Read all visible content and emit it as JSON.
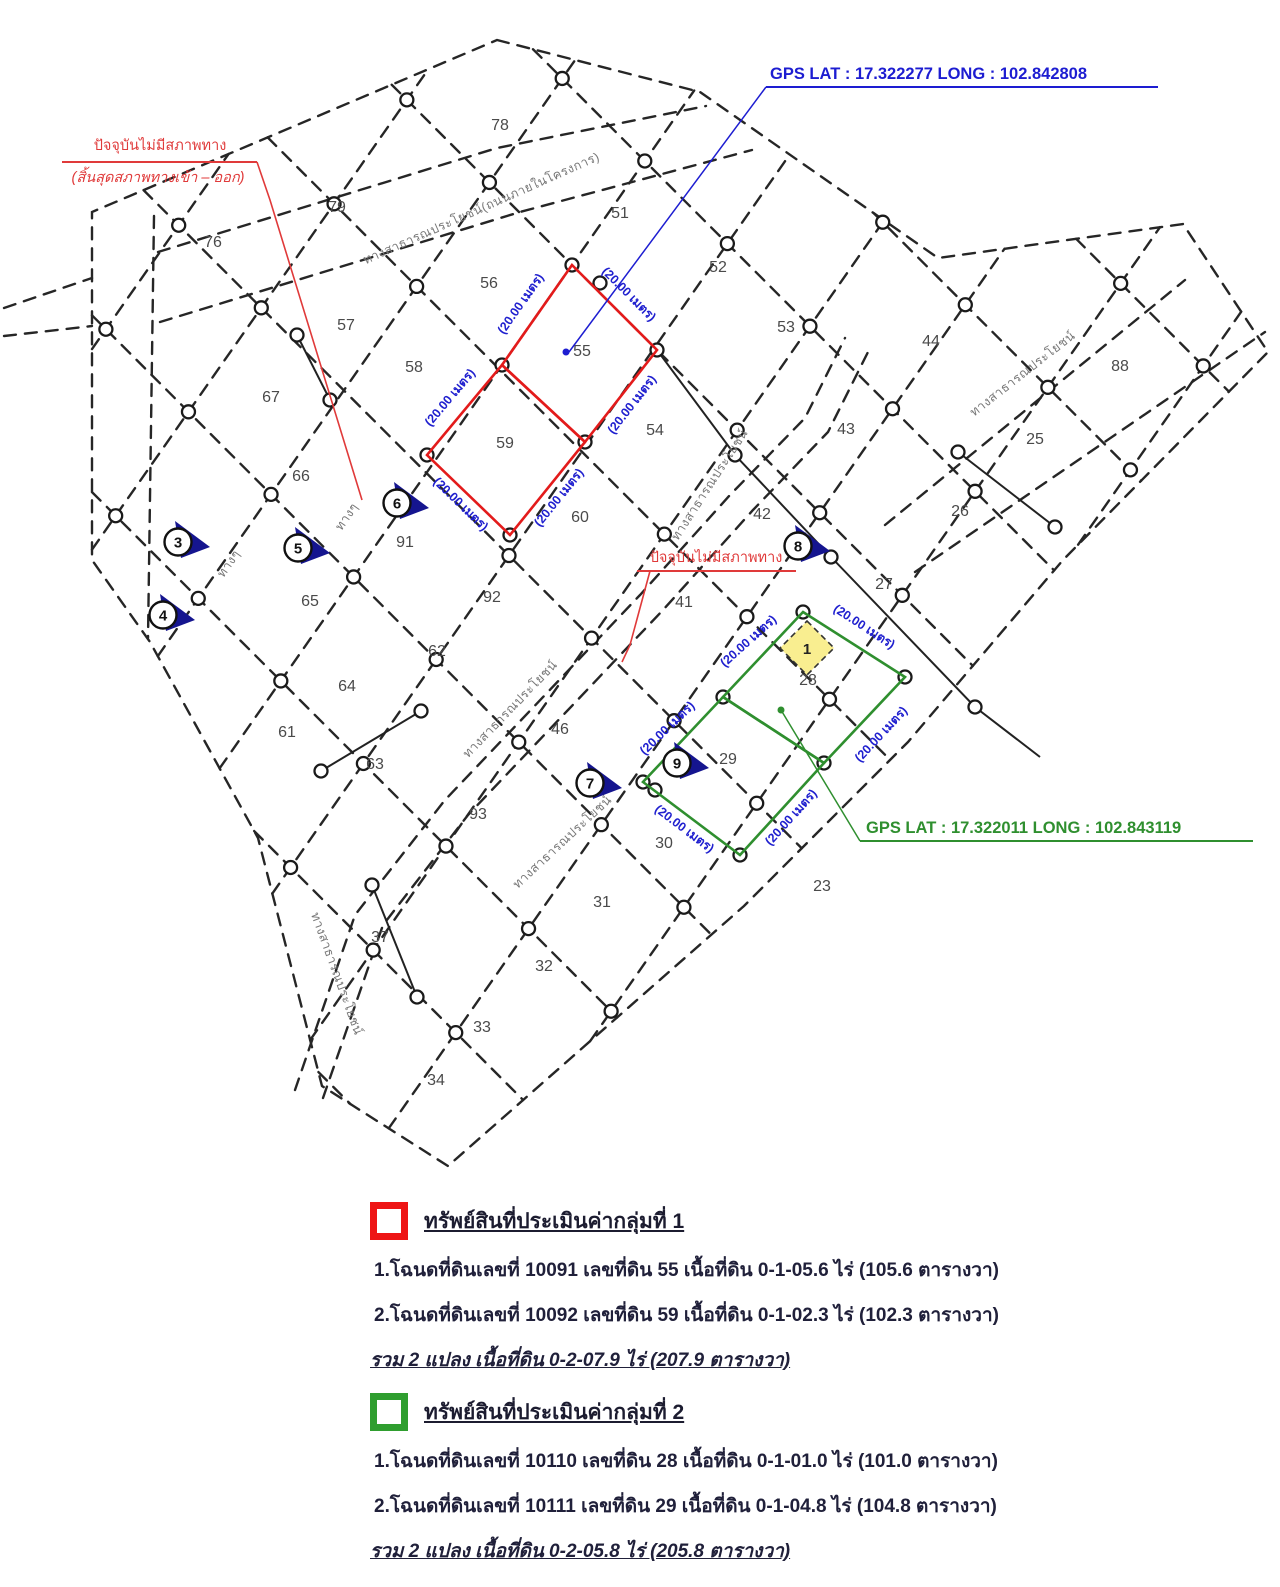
{
  "map": {
    "line_color": "#262626",
    "dim_text": "(20.00 เมตร)",
    "dim_color": "#2020cf",
    "gps1": {
      "text": "GPS  LAT :  17.322277  LONG :  102.842808",
      "x": 770,
      "y": 79,
      "ul": [
        766,
        87,
        1158
      ],
      "leader": [
        [
          766,
          87
        ],
        [
          569,
          352
        ]
      ],
      "dot": [
        566,
        352
      ],
      "color": "#1d1dd1"
    },
    "gps2": {
      "text": "GPS  LAT :  17.322011  LONG :  102.843119",
      "x": 866,
      "y": 833,
      "ul": [
        860,
        841,
        1253
      ],
      "leader": [
        [
          860,
          841
        ],
        [
          781,
          710
        ]
      ],
      "dot": [
        781,
        710
      ],
      "color": "#2f8f2f"
    },
    "red_note_top": {
      "line1": "ปัจจุบันไม่มีสภาพทาง",
      "line2": "(สิ้นสุดสภาพทางเข้า – ออก)",
      "x": 160,
      "y": 150,
      "ul": [
        62,
        162,
        257
      ],
      "leader": [
        [
          257,
          162
        ],
        [
          270,
          200
        ],
        [
          362,
          500
        ]
      ],
      "color": "#e03a3a"
    },
    "red_note_mid": {
      "text": "ปัจจุบันไม่มีสภาพทาง",
      "x": 716,
      "y": 562,
      "ul": [
        637,
        571,
        796
      ],
      "leader": [
        [
          650,
          571
        ],
        [
          630,
          645
        ],
        [
          622,
          662
        ]
      ],
      "color": "#e03a3a"
    },
    "group1": {
      "color": "#e31b1b",
      "quads": [
        [
          [
            572,
            265
          ],
          [
            657,
            350
          ],
          [
            585,
            442
          ],
          [
            502,
            365
          ]
        ],
        [
          [
            502,
            365
          ],
          [
            585,
            442
          ],
          [
            510,
            535
          ],
          [
            427,
            455
          ]
        ]
      ],
      "dims": [
        [
          524,
          306,
          -55
        ],
        [
          626,
          297,
          45
        ],
        [
          635,
          407,
          -52
        ],
        [
          453,
          400,
          -50
        ],
        [
          458,
          507,
          44
        ],
        [
          562,
          500,
          -51
        ]
      ]
    },
    "group2": {
      "color": "#2f8f2f",
      "quads": [
        [
          [
            803,
            612
          ],
          [
            905,
            677
          ],
          [
            824,
            763
          ],
          [
            723,
            697
          ]
        ],
        [
          [
            723,
            697
          ],
          [
            824,
            763
          ],
          [
            740,
            855
          ],
          [
            643,
            782
          ]
        ]
      ],
      "dims": [
        [
          751,
          644,
          -42
        ],
        [
          862,
          630,
          33
        ],
        [
          884,
          737,
          -47
        ],
        [
          670,
          731,
          -44
        ],
        [
          682,
          832,
          37
        ],
        [
          794,
          820,
          -48
        ]
      ],
      "highlight": {
        "cx": 807,
        "cy": 648,
        "r": 27,
        "fill": "#f9ee90",
        "label": "1"
      }
    },
    "plots": [
      [
        "76",
        213,
        247
      ],
      [
        "79",
        337,
        212
      ],
      [
        "78",
        500,
        130
      ],
      [
        "51",
        620,
        218
      ],
      [
        "52",
        718,
        272
      ],
      [
        "53",
        786,
        332
      ],
      [
        "44",
        931,
        346
      ],
      [
        "88",
        1120,
        371
      ],
      [
        "56",
        489,
        288
      ],
      [
        "57",
        346,
        330
      ],
      [
        "58",
        414,
        372
      ],
      [
        "67",
        271,
        402
      ],
      [
        "66",
        301,
        481
      ],
      [
        "55",
        582,
        356
      ],
      [
        "59",
        505,
        448
      ],
      [
        "54",
        655,
        435
      ],
      [
        "43",
        846,
        434
      ],
      [
        "25",
        1035,
        444
      ],
      [
        "26",
        960,
        516
      ],
      [
        "60",
        580,
        522
      ],
      [
        "42",
        762,
        519
      ],
      [
        "27",
        884,
        589
      ],
      [
        "91",
        405,
        547
      ],
      [
        "92",
        492,
        602
      ],
      [
        "41",
        684,
        607
      ],
      [
        "65",
        310,
        606
      ],
      [
        "62",
        437,
        656
      ],
      [
        "64",
        347,
        691
      ],
      [
        "61",
        287,
        737
      ],
      [
        "63",
        375,
        769
      ],
      [
        "46",
        560,
        734
      ],
      [
        "93",
        478,
        819
      ],
      [
        "28",
        808,
        685
      ],
      [
        "29",
        728,
        764
      ],
      [
        "30",
        664,
        848
      ],
      [
        "23",
        822,
        891
      ],
      [
        "31",
        602,
        907
      ],
      [
        "32",
        544,
        971
      ],
      [
        "33",
        482,
        1032
      ],
      [
        "34",
        436,
        1085
      ],
      [
        "37",
        380,
        942
      ]
    ],
    "roads": [
      [
        "ทางสาธารณประโยชน์(ถนนภายในโครงการ)",
        483,
        212,
        -24
      ],
      [
        "ทางสาธารณประโยชน์",
        1025,
        377,
        -38
      ],
      [
        "ทางสาธารณประโยชน์",
        713,
        487,
        -57
      ],
      [
        "ทางสาธารณประโยชน์",
        513,
        712,
        -46
      ],
      [
        "ทางสาธารณประโยชน์",
        565,
        845,
        -43
      ],
      [
        "ทางสาธารณประโยชน์",
        333,
        975,
        70
      ],
      [
        "ทางๆ",
        232,
        566,
        -55
      ],
      [
        "ทางๆ",
        350,
        519,
        -55
      ]
    ],
    "markers": [
      [
        "3",
        178,
        542
      ],
      [
        "4",
        163,
        615
      ],
      [
        "5",
        298,
        548
      ],
      [
        "6",
        397,
        503
      ],
      [
        "7",
        590,
        783
      ],
      [
        "8",
        798,
        546
      ],
      [
        "9",
        677,
        763
      ]
    ],
    "marker_color": "#15158f",
    "hull": [
      [
        497,
        40
      ],
      [
        700,
        92
      ],
      [
        938,
        258
      ],
      [
        1183,
        224
      ],
      [
        1268,
        352
      ],
      [
        1063,
        560
      ],
      [
        908,
        742
      ],
      [
        744,
        906
      ],
      [
        448,
        1166
      ],
      [
        322,
        1086
      ],
      [
        258,
        838
      ],
      [
        150,
        642
      ],
      [
        92,
        560
      ],
      [
        92,
        212
      ]
    ],
    "grid": {
      "anchor": [
        572,
        265
      ],
      "d1": [
        0.7071,
        0.7071
      ],
      "n1": [
        0.7071,
        -0.7071
      ],
      "s1": 125,
      "kmin": -6,
      "kmax": 4,
      "d2": [
        0.5735,
        -0.8192
      ],
      "n2": [
        0.8192,
        0.5735
      ],
      "s2": 115,
      "mmin": -4,
      "mmax": 5
    },
    "extra_dashed": [
      [
        [
          4,
          308
        ],
        [
          92,
          278
        ]
      ],
      [
        [
          4,
          336
        ],
        [
          92,
          326
        ]
      ],
      [
        [
          154,
          216
        ],
        [
          148,
          638
        ]
      ],
      [
        [
          158,
          252
        ],
        [
          497,
          148
        ],
        [
          706,
          106
        ]
      ],
      [
        [
          160,
          322
        ],
        [
          520,
          212
        ],
        [
          752,
          150
        ]
      ],
      [
        [
          885,
          525
        ],
        [
          1185,
          280
        ]
      ],
      [
        [
          915,
          572
        ],
        [
          1265,
          332
        ]
      ],
      [
        [
          295,
          1090
        ],
        [
          355,
          915
        ],
        [
          445,
          800
        ],
        [
          545,
          695
        ],
        [
          640,
          595
        ],
        [
          730,
          495
        ],
        [
          805,
          418
        ],
        [
          845,
          338
        ]
      ],
      [
        [
          323,
          1098
        ],
        [
          383,
          925
        ],
        [
          468,
          815
        ],
        [
          568,
          710
        ],
        [
          663,
          610
        ],
        [
          753,
          510
        ],
        [
          828,
          432
        ],
        [
          868,
          352
        ]
      ]
    ],
    "solid_lines": [
      [
        [
          657,
          350
        ],
        [
          735,
          455
        ],
        [
          831,
          557
        ],
        [
          975,
          707
        ],
        [
          1040,
          757
        ]
      ],
      [
        [
          958,
          452
        ],
        [
          1055,
          527
        ]
      ],
      [
        [
          421,
          711
        ],
        [
          321,
          771
        ]
      ],
      [
        [
          372,
          885
        ],
        [
          417,
          997
        ]
      ],
      [
        [
          297,
          335
        ],
        [
          330,
          400
        ]
      ]
    ],
    "extra_monuments": [
      [
        572,
        265
      ],
      [
        657,
        350
      ],
      [
        585,
        442
      ],
      [
        502,
        365
      ],
      [
        427,
        455
      ],
      [
        510,
        535
      ],
      [
        600,
        283
      ],
      [
        803,
        612
      ],
      [
        905,
        677
      ],
      [
        824,
        763
      ],
      [
        723,
        697
      ],
      [
        643,
        782
      ],
      [
        740,
        855
      ],
      [
        655,
        790
      ],
      [
        735,
        455
      ],
      [
        831,
        557
      ],
      [
        975,
        707
      ],
      [
        958,
        452
      ],
      [
        1055,
        527
      ],
      [
        421,
        711
      ],
      [
        321,
        771
      ],
      [
        372,
        885
      ],
      [
        417,
        997
      ],
      [
        297,
        335
      ],
      [
        330,
        400
      ]
    ]
  },
  "legend": {
    "groups": [
      {
        "color": "#ee1515",
        "heading": "ทรัพย์สินที่ประเมินค่ากลุ่มที่ 1",
        "items": [
          "1.โฉนดที่ดินเลขที่ 10091 เลขที่ดิน 55 เนื้อที่ดิน 0-1-05.6 ไร่ (105.6 ตารางวา)",
          "2.โฉนดที่ดินเลขที่ 10092 เลขที่ดิน 59 เนื้อที่ดิน 0-1-02.3 ไร่ (102.3 ตารางวา)"
        ],
        "total": "รวม 2 แปลง เนื้อที่ดิน 0-2-07.9 ไร่ (207.9 ตารางวา)"
      },
      {
        "color": "#2f9e2f",
        "heading": "ทรัพย์สินที่ประเมินค่ากลุ่มที่ 2",
        "items": [
          "1.โฉนดที่ดินเลขที่ 10110 เลขที่ดิน 28 เนื้อที่ดิน 0-1-01.0 ไร่ (101.0 ตารางวา)",
          "2.โฉนดที่ดินเลขที่ 10111 เลขที่ดิน 29 เนื้อที่ดิน 0-1-04.8 ไร่ (104.8 ตารางวา)"
        ],
        "total": "รวม 2 แปลง เนื้อที่ดิน 0-2-05.8 ไร่ (205.8 ตารางวา)"
      }
    ]
  }
}
